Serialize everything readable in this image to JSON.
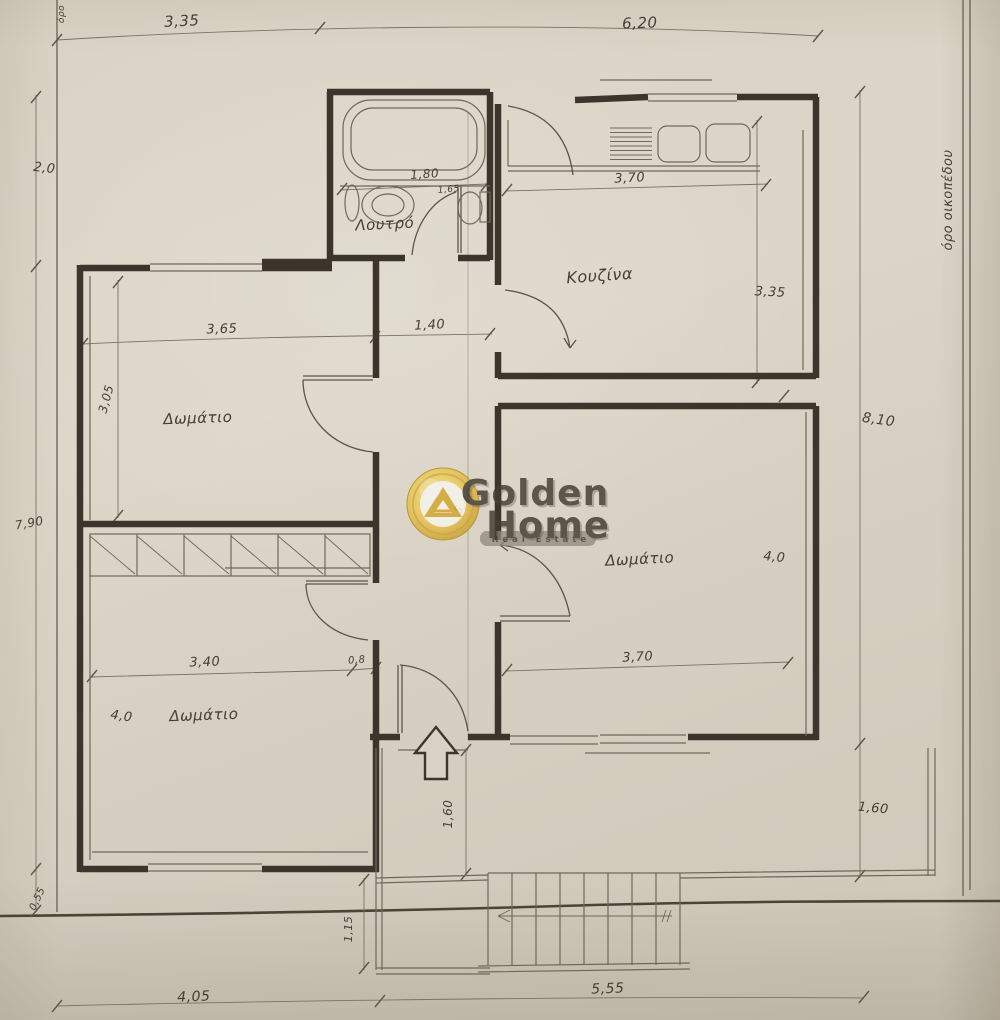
{
  "watermark": {
    "brand_line1": "Golden",
    "brand_line2": "Home",
    "banner": "Real Estate"
  },
  "boundary": {
    "right_label": "όρο οικοπέδου",
    "top_left_label": "όρο"
  },
  "rooms": {
    "bathroom": "Λουτρό",
    "kitchen": "Κουζίνα",
    "left_room": "Δωμάτιο",
    "right_room": "Δωμάτιο",
    "bottom_room": "Δωμάτιο"
  },
  "dims": {
    "top_left_wing": "3,35",
    "top_right_wing": "6,20",
    "left_upper": "2,0",
    "left_main": "7,90",
    "left_bottom": "0,55",
    "right_total": "8,10",
    "right_terrace": "1,60",
    "bath_width": "1,80",
    "bath_door": "1,65",
    "kitchen_width": "3,70",
    "kitchen_depth": "3,35",
    "hall_width": "1,40",
    "left_room_width": "3,65",
    "left_room_depth": "3,05",
    "right_room_width": "3,70",
    "right_room_depth": "4,0",
    "bottom_room_width": "3,40",
    "bottom_room_jog": "0,8",
    "bottom_room_depth": "4,0",
    "hall_diagonal": "5,40",
    "porch_depth": "1,60",
    "stair_depth": "1,15",
    "bottom_left": "4,05",
    "bottom_right": "5,55"
  },
  "colors": {
    "paper": "#d8d1c3",
    "wall_ink": "#3b352c",
    "thin_ink": "#6f685b",
    "dim_ink": "#776f62",
    "logo_gold": "#d2a72e",
    "banner_grey": "#8f897d"
  }
}
